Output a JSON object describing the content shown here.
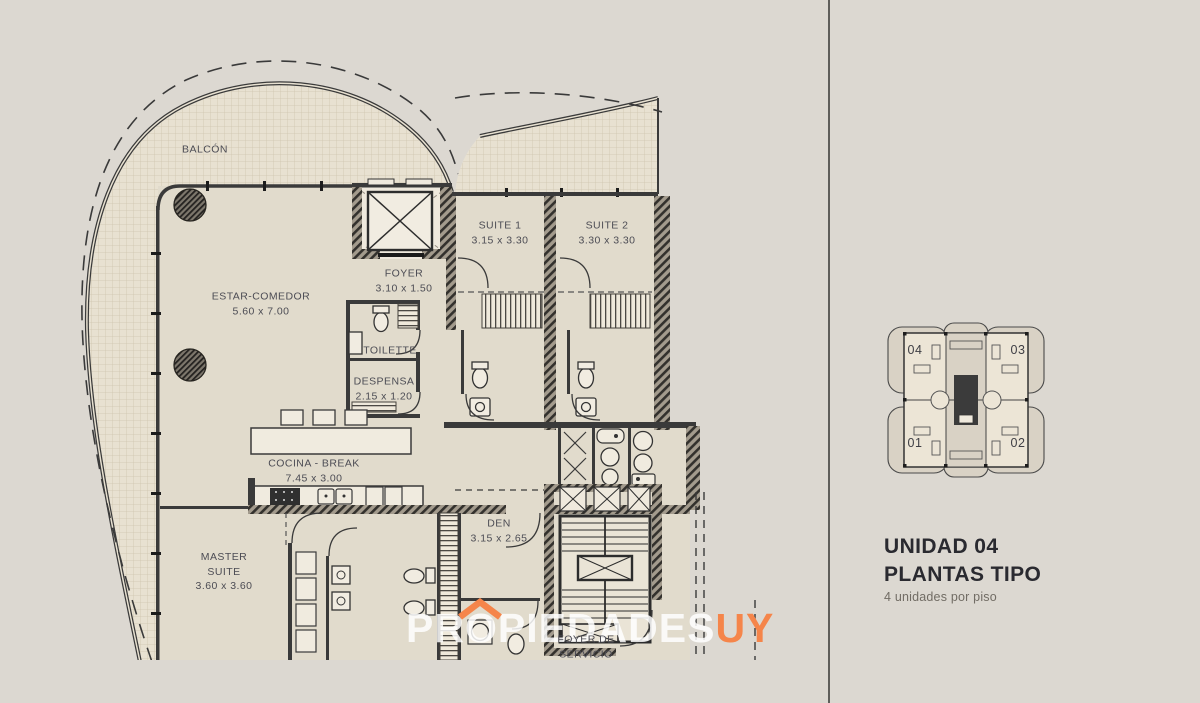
{
  "plan": {
    "balcony": "BALCÓN",
    "estar": {
      "name": "ESTAR-COMEDOR",
      "dims": "5.60 x 7.00"
    },
    "foyer": {
      "name": "FOYER",
      "dims": "3.10 x 1.50"
    },
    "suite1": {
      "name": "SUITE 1",
      "dims": "3.15 x 3.30"
    },
    "suite2": {
      "name": "SUITE 2",
      "dims": "3.30 x 3.30"
    },
    "toilette": {
      "name": "TOILETTE"
    },
    "despensa": {
      "name": "DESPENSA",
      "dims": "2.15 x 1.20"
    },
    "cocina": {
      "name": "COCINA - BREAK",
      "dims": "7.45 x 3.00"
    },
    "master": {
      "name": "MASTER SUITE",
      "dims": "3.60 x 3.60"
    },
    "den": {
      "name": "DEN",
      "dims": "3.15 x 2.65"
    },
    "servicio": {
      "name": "FOYER DE SERVICIO"
    }
  },
  "keyplan": {
    "unit_tl": "04",
    "unit_tr": "03",
    "unit_bl": "01",
    "unit_br": "02"
  },
  "sidebar": {
    "title_line1": "UNIDAD 04",
    "title_line2": "PLANTAS TIPO",
    "subtitle": "4 unidades por piso"
  },
  "watermark": {
    "brand": "PROPIEDADES",
    "suffix": "UY"
  },
  "colors": {
    "background": "#dcd8d1",
    "wall": "#3a3a3a",
    "floor": "#e1dbcc",
    "accent_orange": "#f5854a"
  }
}
